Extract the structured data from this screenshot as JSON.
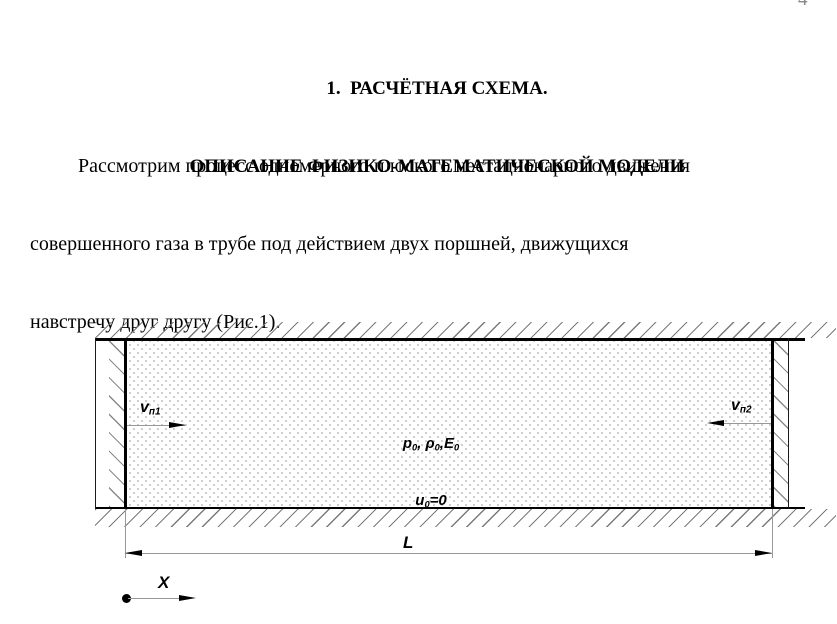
{
  "page": {
    "number": "4"
  },
  "heading": {
    "lines": [
      "1.  РАСЧЁТНАЯ СХЕМА.",
      "ОПИСАНИЕ ФИЗИКО-МАТЕМАТИЧЕСКОЙ МОДЕЛИ"
    ]
  },
  "paragraph": {
    "lines": [
      "Рассмотрим процесс одномерного плоского нестационарного движения",
      "совершенного газа в трубе под действием двух поршней, движущихся",
      "навстречу друг другу (Рис.1)."
    ]
  },
  "figure": {
    "piston1_velocity": {
      "base": "v",
      "sub": "п1"
    },
    "piston2_velocity": {
      "base": "v",
      "sub": "п2"
    },
    "gas_state": {
      "line1": [
        {
          "t": "p",
          "s": "0"
        },
        {
          "t": ", ",
          "s": ""
        },
        {
          "t": "ρ",
          "s": "0"
        },
        {
          "t": ",",
          "s": ""
        },
        {
          "t": "E",
          "s": "0"
        }
      ],
      "line2": [
        {
          "t": "u",
          "s": "0"
        },
        {
          "t": "=0",
          "s": ""
        }
      ]
    },
    "length_label": "L",
    "axis_label": "X"
  },
  "colors": {
    "ink": "#000000",
    "thin_line": "#999999",
    "hatch": "#7a7a7a",
    "dots": "#c9c9c9",
    "page_number": "#8a8a8a"
  }
}
